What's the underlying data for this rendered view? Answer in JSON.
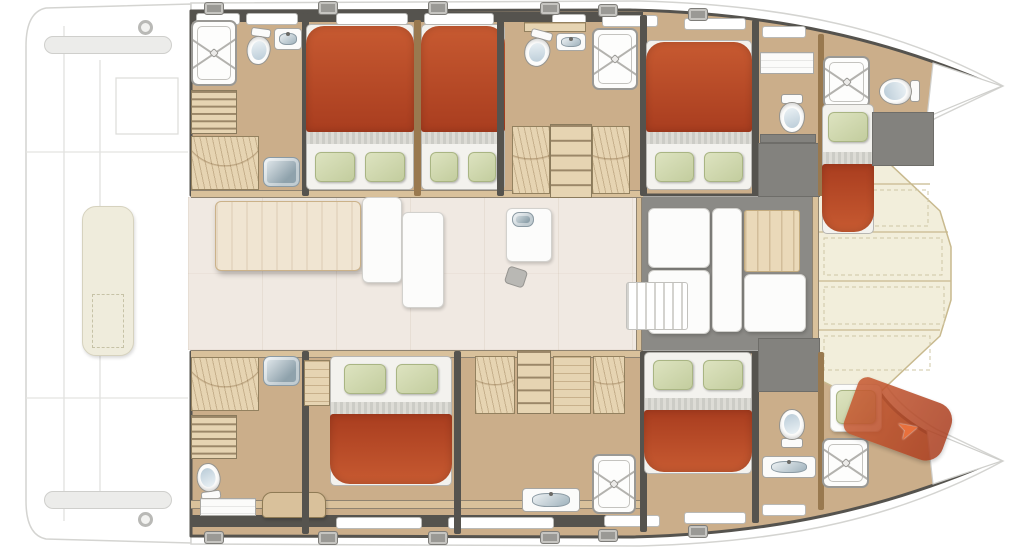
{
  "diagram": {
    "kind": "catamaran-interior-floorplan",
    "view": "top-down",
    "hulls": [
      "port-hull-top",
      "starboard-hull-bottom"
    ],
    "rooms": [
      "aft-head-port",
      "cabin-a",
      "cabin-b",
      "mid-head-port",
      "cabin-c",
      "fwd-head-port",
      "bow-cabin-port",
      "aft-head-stbd",
      "cabin-d",
      "mid-corridor-stbd",
      "cabin-e",
      "fwd-head-stbd",
      "bow-crew-cabin-stbd",
      "saloon",
      "forward-cockpit",
      "foredeck",
      "aft-deck"
    ]
  },
  "colors": {
    "wood": "#cbae8a",
    "woodLight": "#e6d4b2",
    "woodMid": "#d9c19b",
    "woodDark": "#99794f",
    "wall": "#55534e",
    "gray": "#8b8a86",
    "salon": "#f0e9e2",
    "cream": "#f2eedb",
    "bedRed1": "#c75a31",
    "bedRed2": "#a93d1f",
    "pillow1": "#dde3c0",
    "pillow2": "#c3cd9e",
    "steel1": "#e8eef1",
    "steel2": "#8fa2ac"
  },
  "fixtures": [
    {
      "n": "stern-beam-top",
      "t": "beam",
      "x": 44,
      "y": 36,
      "w": 128,
      "h": 18
    },
    {
      "n": "stern-beam-bottom",
      "t": "beam",
      "x": 44,
      "y": 491,
      "w": 128,
      "h": 18
    },
    {
      "n": "stern-lounge-pad",
      "t": "pad",
      "x": 82,
      "y": 206,
      "w": 52,
      "h": 150
    },
    {
      "n": "stern-pad-hatch",
      "t": "padline",
      "x": 92,
      "y": 294,
      "w": 32,
      "h": 54
    },
    {
      "n": "cleat-aft-port",
      "t": "ringfx",
      "x": 138,
      "y": 20,
      "w": 15,
      "h": 15
    },
    {
      "n": "cleat-aft-stbd",
      "t": "ringfx",
      "x": 138,
      "y": 512,
      "w": 15,
      "h": 15
    },
    {
      "n": "saloon-floor",
      "t": "floor",
      "x": 188,
      "y": 197,
      "w": 452,
      "h": 153
    },
    {
      "n": "fwd-cockpit-floor",
      "t": "grayfloor",
      "x": 640,
      "y": 197,
      "w": 176,
      "h": 153
    },
    {
      "n": "saloon-cockpit-threshold",
      "t": "vstrip",
      "x": 636,
      "y": 197,
      "w": 6,
      "h": 153
    },
    {
      "n": "foredeck-threshold",
      "t": "vstrip",
      "x": 812,
      "y": 166,
      "w": 7,
      "h": 216
    },
    {
      "n": "port-hull-wallband",
      "t": "wallband",
      "x": 191,
      "y": 12,
      "w": 452,
      "h": 10
    },
    {
      "n": "port-hull-trim",
      "t": "strip",
      "x": 191,
      "y": 190,
      "w": 452,
      "h": 8
    },
    {
      "n": "stbd-hull-trim",
      "t": "strip",
      "x": 191,
      "y": 350,
      "w": 452,
      "h": 8
    },
    {
      "n": "stbd-hull-lower-trim",
      "t": "strip",
      "x": 191,
      "y": 500,
      "w": 452,
      "h": 9
    },
    {
      "n": "stbd-hull-wallband",
      "t": "wallband",
      "x": 191,
      "y": 515,
      "w": 452,
      "h": 12
    },
    {
      "n": "hull-window-t1",
      "t": "window",
      "x": 196,
      "y": 13,
      "w": 44,
      "h": 12
    },
    {
      "n": "hull-window-t2",
      "t": "window",
      "x": 246,
      "y": 13,
      "w": 52,
      "h": 12
    },
    {
      "n": "hull-window-t3",
      "t": "window",
      "x": 336,
      "y": 13,
      "w": 72,
      "h": 12
    },
    {
      "n": "hull-window-t4",
      "t": "window",
      "x": 424,
      "y": 13,
      "w": 70,
      "h": 12
    },
    {
      "n": "hull-window-t5",
      "t": "window",
      "x": 552,
      "y": 14,
      "w": 34,
      "h": 12
    },
    {
      "n": "hull-window-t6",
      "t": "window",
      "x": 602,
      "y": 15,
      "w": 56,
      "h": 12
    },
    {
      "n": "hull-window-t7",
      "t": "window",
      "x": 684,
      "y": 18,
      "w": 62,
      "h": 12
    },
    {
      "n": "hull-window-t8",
      "t": "window",
      "x": 762,
      "y": 26,
      "w": 44,
      "h": 12
    },
    {
      "n": "deck-hatch-t1",
      "t": "hatch",
      "x": 204,
      "y": 2,
      "w": 20,
      "h": 13
    },
    {
      "n": "deck-hatch-t2",
      "t": "hatch",
      "x": 318,
      "y": 1,
      "w": 20,
      "h": 14
    },
    {
      "n": "deck-hatch-t3",
      "t": "hatch",
      "x": 428,
      "y": 1,
      "w": 20,
      "h": 14
    },
    {
      "n": "deck-hatch-t4",
      "t": "hatch",
      "x": 540,
      "y": 2,
      "w": 20,
      "h": 13
    },
    {
      "n": "deck-hatch-t5",
      "t": "hatch",
      "x": 598,
      "y": 4,
      "w": 20,
      "h": 13
    },
    {
      "n": "deck-hatch-t6",
      "t": "hatch",
      "x": 688,
      "y": 8,
      "w": 20,
      "h": 13
    },
    {
      "n": "hull-window-b1",
      "t": "window",
      "x": 336,
      "y": 517,
      "w": 86,
      "h": 12
    },
    {
      "n": "hull-window-b2",
      "t": "window",
      "x": 448,
      "y": 517,
      "w": 106,
      "h": 12
    },
    {
      "n": "hull-window-b3",
      "t": "window",
      "x": 604,
      "y": 515,
      "w": 56,
      "h": 12
    },
    {
      "n": "hull-window-b4",
      "t": "window",
      "x": 684,
      "y": 512,
      "w": 62,
      "h": 12
    },
    {
      "n": "hull-window-b5",
      "t": "window",
      "x": 762,
      "y": 504,
      "w": 44,
      "h": 12
    },
    {
      "n": "deck-hatch-b1",
      "t": "hatch",
      "x": 204,
      "y": 531,
      "w": 20,
      "h": 13
    },
    {
      "n": "deck-hatch-b2",
      "t": "hatch",
      "x": 318,
      "y": 531,
      "w": 20,
      "h": 14
    },
    {
      "n": "deck-hatch-b3",
      "t": "hatch",
      "x": 428,
      "y": 531,
      "w": 20,
      "h": 14
    },
    {
      "n": "deck-hatch-b4",
      "t": "hatch",
      "x": 540,
      "y": 531,
      "w": 20,
      "h": 13
    },
    {
      "n": "deck-hatch-b5",
      "t": "hatch",
      "x": 598,
      "y": 529,
      "w": 20,
      "h": 13
    },
    {
      "n": "deck-hatch-b6",
      "t": "hatch",
      "x": 688,
      "y": 525,
      "w": 20,
      "h": 13
    },
    {
      "n": "shower-aft-port",
      "t": "shower",
      "x": 191,
      "y": 20,
      "w": 46,
      "h": 66
    },
    {
      "n": "toilet-aft-port",
      "t": "toilet",
      "x": 246,
      "y": 28,
      "w": 26,
      "h": 38,
      "r": 8
    },
    {
      "n": "sink-aft-port",
      "t": "sink",
      "x": 274,
      "y": 28,
      "w": 28,
      "h": 22
    },
    {
      "n": "stairs-aft-port",
      "t": "stairs",
      "x": 191,
      "y": 90,
      "w": 46,
      "h": 44,
      "s": 6
    },
    {
      "n": "wardrobe-aft-port",
      "t": "wardrobe",
      "x": 191,
      "y": 136,
      "w": 68,
      "h": 54
    },
    {
      "n": "basin-aft-port",
      "t": "sinkSteel",
      "x": 263,
      "y": 157,
      "w": 37,
      "h": 30
    },
    {
      "n": "wall-aft-port",
      "t": "wall",
      "x": 302,
      "y": 13,
      "w": 7,
      "h": 183
    },
    {
      "n": "bed-cabin-a",
      "t": "bedD",
      "x": 306,
      "y": 24,
      "w": 108,
      "h": 166,
      "d": "bottom"
    },
    {
      "n": "divider-cabin-ab",
      "t": "wallwood",
      "x": 414,
      "y": 20,
      "w": 7,
      "h": 176
    },
    {
      "n": "bed-cabin-b",
      "t": "bedD",
      "x": 421,
      "y": 24,
      "w": 84,
      "h": 166,
      "d": "bottom"
    },
    {
      "n": "wall-cabin-b",
      "t": "wall",
      "x": 497,
      "y": 13,
      "w": 7,
      "h": 183
    },
    {
      "n": "shelf-mid-port",
      "t": "woodshelf",
      "x": 524,
      "y": 22,
      "w": 62,
      "h": 10
    },
    {
      "n": "toilet-mid-port",
      "t": "toilet",
      "x": 524,
      "y": 30,
      "w": 28,
      "h": 38,
      "r": 15
    },
    {
      "n": "sink-mid-port",
      "t": "sink",
      "x": 556,
      "y": 33,
      "w": 30,
      "h": 18
    },
    {
      "n": "shower-mid-port",
      "t": "shower",
      "x": 592,
      "y": 28,
      "w": 46,
      "h": 62
    },
    {
      "n": "wardrobe-mid-port-l",
      "t": "wardrobe",
      "x": 512,
      "y": 126,
      "w": 38,
      "h": 68
    },
    {
      "n": "stairs-mid-port",
      "t": "stairs",
      "x": 550,
      "y": 124,
      "w": 42,
      "h": 74,
      "s": 5
    },
    {
      "n": "wardrobe-mid-port-r",
      "t": "wardrobe",
      "x": 592,
      "y": 126,
      "w": 38,
      "h": 68
    },
    {
      "n": "wall-mid-port",
      "t": "wall",
      "x": 640,
      "y": 15,
      "w": 7,
      "h": 181
    },
    {
      "n": "bed-cabin-c",
      "t": "bedD",
      "x": 646,
      "y": 40,
      "w": 106,
      "h": 150,
      "d": "bottom"
    },
    {
      "n": "wall-cabin-c",
      "t": "wall",
      "x": 752,
      "y": 20,
      "w": 7,
      "h": 176
    },
    {
      "n": "shelf-fwd-port",
      "t": "counter",
      "x": 760,
      "y": 52,
      "w": 54,
      "h": 22
    },
    {
      "n": "toilet-fwd-port",
      "t": "toilet",
      "x": 778,
      "y": 94,
      "w": 28,
      "h": 40
    },
    {
      "n": "shelf-dark-fwd-port",
      "t": "locker",
      "x": 760,
      "y": 134,
      "w": 56,
      "h": 9
    },
    {
      "n": "locker-fwd-port",
      "t": "locker",
      "x": 758,
      "y": 143,
      "w": 62,
      "h": 54
    },
    {
      "n": "wall-fwd-port",
      "t": "wallwood",
      "x": 818,
      "y": 34,
      "w": 6,
      "h": 162
    },
    {
      "n": "shower-bow-port",
      "t": "shower",
      "x": 823,
      "y": 56,
      "w": 47,
      "h": 52
    },
    {
      "n": "toilet-bow-port",
      "t": "toilet",
      "x": 884,
      "y": 70,
      "w": 30,
      "h": 42,
      "r": 90
    },
    {
      "n": "bed-bow-port",
      "t": "bedS",
      "x": 822,
      "y": 104,
      "w": 52,
      "h": 130,
      "d": "top"
    },
    {
      "n": "locker-bow-port",
      "t": "locker",
      "x": 872,
      "y": 112,
      "w": 62,
      "h": 54
    },
    {
      "n": "wardrobe-aft-stbd",
      "t": "wardrobe",
      "x": 191,
      "y": 357,
      "w": 68,
      "h": 54
    },
    {
      "n": "basin-aft-stbd",
      "t": "sinkSteel",
      "x": 263,
      "y": 356,
      "w": 37,
      "h": 30
    },
    {
      "n": "stairs-aft-stbd",
      "t": "stairs",
      "x": 191,
      "y": 415,
      "w": 46,
      "h": 44,
      "s": 6
    },
    {
      "n": "toilet-aft-stbd",
      "t": "toilet",
      "x": 196,
      "y": 462,
      "w": 26,
      "h": 38,
      "r": 172
    },
    {
      "n": "counter-aft-stbd",
      "t": "counter",
      "x": 200,
      "y": 498,
      "w": 56,
      "h": 18
    },
    {
      "n": "desk-aft-stbd",
      "t": "desk",
      "x": 262,
      "y": 492,
      "w": 64,
      "h": 26
    },
    {
      "n": "wall-aft-stbd",
      "t": "wall",
      "x": 302,
      "y": 351,
      "w": 7,
      "h": 183
    },
    {
      "n": "shelf-cabin-d",
      "t": "woodshelf",
      "x": 304,
      "y": 360,
      "w": 26,
      "h": 46
    },
    {
      "n": "bed-cabin-d",
      "t": "bedD",
      "x": 330,
      "y": 356,
      "w": 122,
      "h": 130,
      "d": "top"
    },
    {
      "n": "wall-cabin-d",
      "t": "wall",
      "x": 454,
      "y": 351,
      "w": 7,
      "h": 183
    },
    {
      "n": "wardrobe-mid-stbd-l",
      "t": "wardrobe",
      "x": 475,
      "y": 356,
      "w": 40,
      "h": 58
    },
    {
      "n": "stairs-mid-stbd",
      "t": "stairs",
      "x": 517,
      "y": 350,
      "w": 34,
      "h": 64,
      "s": 5
    },
    {
      "n": "shelf-mid-stbd",
      "t": "woodshelf",
      "x": 553,
      "y": 356,
      "w": 38,
      "h": 58
    },
    {
      "n": "wardrobe-mid-stbd-r",
      "t": "wardrobe",
      "x": 593,
      "y": 356,
      "w": 32,
      "h": 58
    },
    {
      "n": "vanity-mid-stbd",
      "t": "sink",
      "x": 522,
      "y": 488,
      "w": 58,
      "h": 24
    },
    {
      "n": "shower-mid-stbd",
      "t": "shower",
      "x": 592,
      "y": 454,
      "w": 44,
      "h": 60
    },
    {
      "n": "wall-mid-stbd",
      "t": "wall",
      "x": 640,
      "y": 351,
      "w": 7,
      "h": 181
    },
    {
      "n": "bed-cabin-e",
      "t": "bedD",
      "x": 644,
      "y": 352,
      "w": 108,
      "h": 122,
      "d": "top"
    },
    {
      "n": "wall-cabin-e",
      "t": "wall",
      "x": 752,
      "y": 351,
      "w": 7,
      "h": 172
    },
    {
      "n": "locker-fwd-stbd",
      "t": "locker",
      "x": 758,
      "y": 338,
      "w": 62,
      "h": 54
    },
    {
      "n": "toilet-fwd-stbd",
      "t": "toilet",
      "x": 778,
      "y": 408,
      "w": 28,
      "h": 40,
      "r": 180
    },
    {
      "n": "vanity-fwd-stbd",
      "t": "sink",
      "x": 762,
      "y": 456,
      "w": 54,
      "h": 22
    },
    {
      "n": "wall-fwd-stbd",
      "t": "wallwood",
      "x": 818,
      "y": 352,
      "w": 6,
      "h": 158
    },
    {
      "n": "shower-bow-stbd",
      "t": "shower",
      "x": 822,
      "y": 438,
      "w": 47,
      "h": 50
    },
    {
      "n": "berth-pad-bow-stbd",
      "t": "lounge",
      "x": 830,
      "y": 384,
      "w": 52,
      "h": 48
    },
    {
      "n": "pillow-bow-stbd",
      "t": "pillowfx",
      "x": 836,
      "y": 390,
      "w": 40,
      "h": 34
    },
    {
      "n": "berth-bow-stbd",
      "t": "redwedge",
      "x": 848,
      "y": 390,
      "w": 102,
      "h": 60,
      "r": 20
    },
    {
      "n": "access-arrow-icon",
      "t": "arrow",
      "x": 898,
      "y": 414,
      "w": 34,
      "h": 34,
      "r": -15,
      "g": "➤"
    },
    {
      "n": "saloon-table",
      "t": "table",
      "x": 215,
      "y": 201,
      "w": 146,
      "h": 70
    },
    {
      "n": "saloon-bench-1",
      "t": "lounge",
      "x": 362,
      "y": 197,
      "w": 40,
      "h": 86
    },
    {
      "n": "saloon-bench-2",
      "t": "lounge",
      "x": 402,
      "y": 212,
      "w": 42,
      "h": 96
    },
    {
      "n": "galley-unit",
      "t": "lounge",
      "x": 506,
      "y": 208,
      "w": 46,
      "h": 54
    },
    {
      "n": "galley-sink",
      "t": "sinkSteel",
      "x": 512,
      "y": 212,
      "w": 22,
      "h": 15
    },
    {
      "n": "galley-stool",
      "t": "stool",
      "x": 506,
      "y": 268,
      "w": 20,
      "h": 18,
      "r": 18
    },
    {
      "n": "cockpit-cushion-1",
      "t": "lounge",
      "x": 648,
      "y": 208,
      "w": 62,
      "h": 60
    },
    {
      "n": "cockpit-cushion-2",
      "t": "lounge",
      "x": 648,
      "y": 270,
      "w": 62,
      "h": 64
    },
    {
      "n": "cockpit-cushion-3",
      "t": "lounge",
      "x": 712,
      "y": 208,
      "w": 30,
      "h": 124
    },
    {
      "n": "cockpit-panel",
      "t": "panelWood",
      "x": 744,
      "y": 210,
      "w": 56,
      "h": 62
    },
    {
      "n": "cockpit-cushion-4",
      "t": "lounge",
      "x": 744,
      "y": 274,
      "w": 62,
      "h": 58
    },
    {
      "n": "cockpit-hatch",
      "t": "slatsV",
      "x": 626,
      "y": 282,
      "w": 62,
      "h": 48
    }
  ]
}
